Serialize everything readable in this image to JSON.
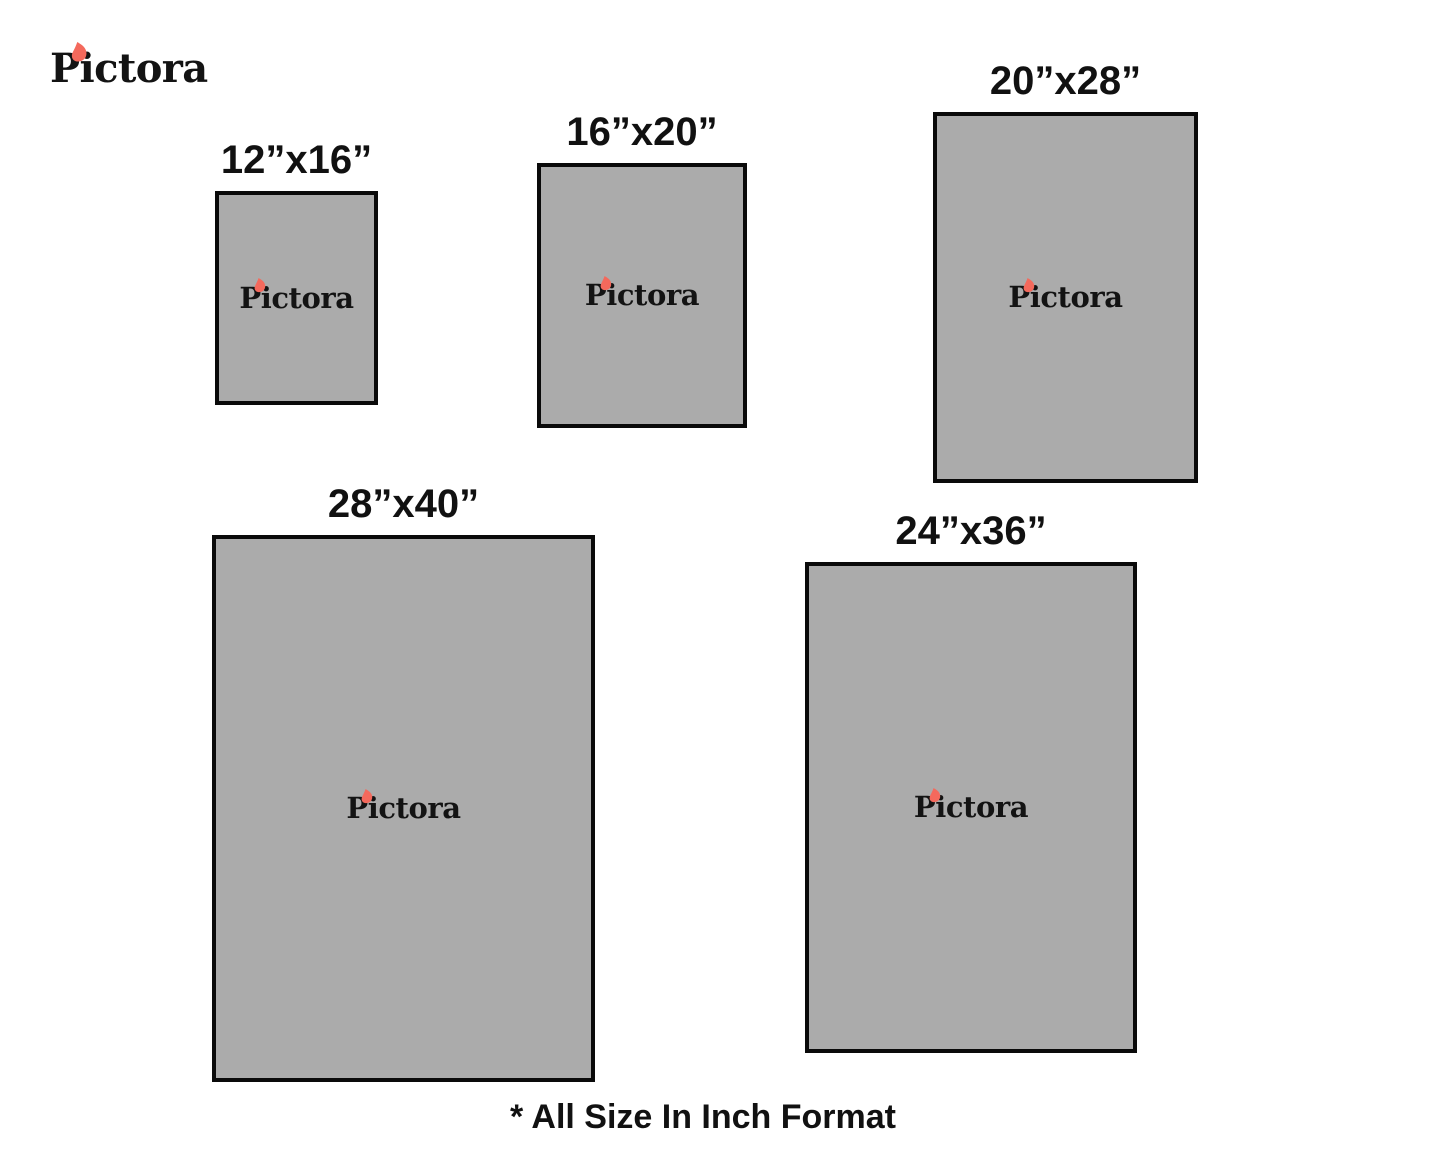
{
  "brand": {
    "name": "Pictora",
    "text_color": "#131313",
    "flame_color": "#f4695c"
  },
  "sizes": [
    {
      "id": "12x16",
      "label": "12”x16”",
      "width_in": 12,
      "height_in": 16
    },
    {
      "id": "16x20",
      "label": "16”x20”",
      "width_in": 16,
      "height_in": 20
    },
    {
      "id": "20x28",
      "label": "20”x28”",
      "width_in": 20,
      "height_in": 28
    },
    {
      "id": "28x40",
      "label": "28”x40”",
      "width_in": 28,
      "height_in": 40
    },
    {
      "id": "24x36",
      "label": "24”x36”",
      "width_in": 24,
      "height_in": 36
    }
  ],
  "box_style": {
    "fill": "#ababab",
    "border_color": "#0a0a0a"
  },
  "footnote": "* All Size In Inch Format"
}
